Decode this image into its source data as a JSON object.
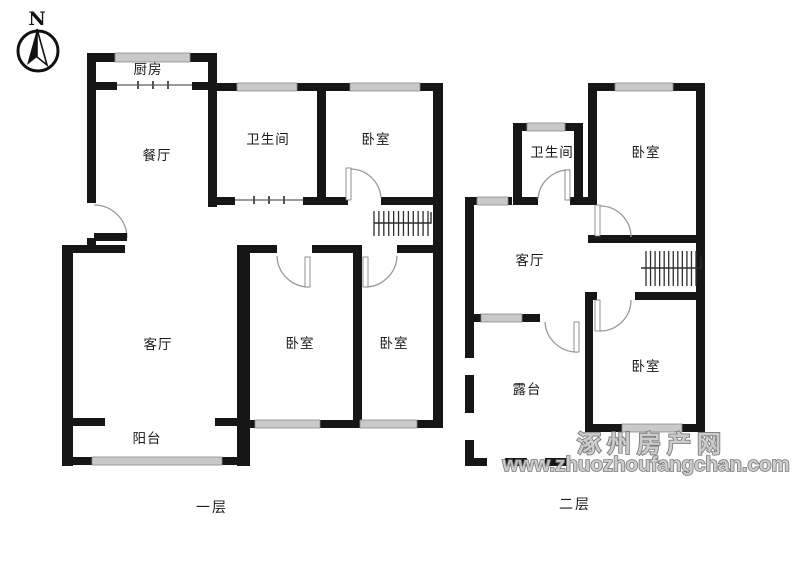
{
  "compass": {
    "label": "N"
  },
  "watermark": {
    "line1": "涿州房产网",
    "line2": "www.zhuozhoufangchan.com",
    "fill_color": "#c9c9c9",
    "outline_color": "#6e6e6e"
  },
  "palette": {
    "wall": "#161616",
    "window": "#c9c9c9",
    "door_arc": "#999999",
    "stairs": "#2e2e2e"
  },
  "floors": [
    {
      "caption": "一层",
      "rooms": [
        {
          "label": "厨房",
          "cx": 148,
          "cy": 69
        },
        {
          "label": "餐厅",
          "cx": 157,
          "cy": 155
        },
        {
          "label": "卫生间",
          "cx": 268,
          "cy": 139
        },
        {
          "label": "卧室",
          "cx": 376,
          "cy": 139
        },
        {
          "label": "客厅",
          "cx": 158,
          "cy": 344
        },
        {
          "label": "卧室",
          "cx": 300,
          "cy": 343
        },
        {
          "label": "卧室",
          "cx": 394,
          "cy": 343
        },
        {
          "label": "阳台",
          "cx": 147,
          "cy": 438
        }
      ],
      "geometry": {
        "walls": [
          [
            87,
            53,
            130,
            9
          ],
          [
            87,
            53,
            9,
            150
          ],
          [
            87,
            238,
            9,
            10
          ],
          [
            87,
            82,
            30,
            8
          ],
          [
            192,
            82,
            25,
            8
          ],
          [
            208,
            53,
            9,
            154
          ],
          [
            217,
            83,
            226,
            8
          ],
          [
            317,
            83,
            9,
            122
          ],
          [
            433,
            83,
            10,
            345
          ],
          [
            208,
            197,
            27,
            8
          ],
          [
            303,
            197,
            45,
            8
          ],
          [
            381,
            197,
            62,
            8
          ],
          [
            62,
            245,
            63,
            8
          ],
          [
            237,
            245,
            40,
            8
          ],
          [
            312,
            245,
            48,
            8
          ],
          [
            397,
            245,
            46,
            8
          ],
          [
            62,
            245,
            11,
            221
          ],
          [
            237,
            245,
            13,
            221
          ],
          [
            353,
            245,
            9,
            183
          ],
          [
            237,
            420,
            206,
            8
          ],
          [
            62,
            418,
            43,
            8
          ],
          [
            215,
            418,
            35,
            8
          ],
          [
            62,
            457,
            186,
            8
          ]
        ],
        "windows": [
          [
            115,
            53,
            75,
            9
          ],
          [
            237,
            83,
            60,
            8
          ],
          [
            350,
            83,
            70,
            8
          ],
          [
            255,
            420,
            65,
            8
          ],
          [
            360,
            420,
            57,
            8
          ],
          [
            92,
            457,
            130,
            8
          ]
        ],
        "thin_lines": [
          {
            "x": 117,
            "y": 84,
            "len": 75,
            "ticks": [
              137,
              152,
              167
            ]
          },
          {
            "x": 235,
            "y": 199,
            "len": 68,
            "ticks": [
              253,
              268,
              283
            ]
          }
        ],
        "dashes": [],
        "doors": [
          {
            "leaf": [
              94,
              233,
              33,
              8
            ],
            "style": "solid",
            "arc": "M 94 205 A 33 33 0 0 1 127 238"
          },
          {
            "leaf": [
              346,
              168,
              5,
              32
            ],
            "style": "open",
            "arc": "M 351 169 A 31 31 0 0 1 381 198"
          },
          {
            "leaf": [
              305,
              257,
              5,
              30
            ],
            "style": "open",
            "arc": "M 277 256 A 32 32 0 0 0 309 287"
          },
          {
            "leaf": [
              363,
              257,
              5,
              30
            ],
            "style": "open",
            "arc": "M 366 287 A 32 32 0 0 0 397 256"
          }
        ],
        "stairs": {
          "x": 374,
          "y": 211,
          "w": 54,
          "h": 25,
          "steps": 12,
          "line": "M 374 223 L 431 223 L 431 212"
        }
      }
    },
    {
      "caption": "二层",
      "rooms": [
        {
          "label": "卫生间",
          "cx": 552,
          "cy": 152
        },
        {
          "label": "卧室",
          "cx": 646,
          "cy": 152
        },
        {
          "label": "客厅",
          "cx": 530,
          "cy": 260
        },
        {
          "label": "卧室",
          "cx": 646,
          "cy": 366
        },
        {
          "label": "露台",
          "cx": 527,
          "cy": 389
        }
      ],
      "geometry": {
        "walls": [
          [
            465,
            197,
            9,
            161
          ],
          [
            465,
            197,
            47,
            8
          ],
          [
            513,
            123,
            9,
            82
          ],
          [
            513,
            123,
            70,
            8
          ],
          [
            574,
            123,
            9,
            82
          ],
          [
            513,
            197,
            25,
            8
          ],
          [
            570,
            197,
            27,
            8
          ],
          [
            588,
            83,
            9,
            122
          ],
          [
            588,
            83,
            117,
            8
          ],
          [
            696,
            83,
            9,
            349
          ],
          [
            588,
            235,
            117,
            8
          ],
          [
            588,
            292,
            9,
            8
          ],
          [
            635,
            292,
            70,
            8
          ],
          [
            585,
            292,
            8,
            140
          ],
          [
            585,
            424,
            120,
            8
          ],
          [
            465,
            314,
            16,
            8
          ],
          [
            522,
            314,
            18,
            8
          ]
        ],
        "windows": [
          [
            477,
            197,
            31,
            8
          ],
          [
            527,
            123,
            38,
            8
          ],
          [
            615,
            83,
            58,
            8
          ],
          [
            622,
            424,
            60,
            8
          ],
          [
            481,
            314,
            41,
            8
          ]
        ],
        "thin_lines": [],
        "dashes": [
          [
            465,
            375,
            9,
            38
          ],
          [
            465,
            440,
            9,
            26
          ],
          [
            465,
            458,
            22,
            8
          ],
          [
            505,
            458,
            22,
            8
          ],
          [
            545,
            458,
            22,
            8
          ]
        ],
        "doors": [
          {
            "leaf": [
              565,
              170,
              5,
              30
            ],
            "style": "open",
            "arc": "M 538 199 A 31 31 0 0 1 570 170"
          },
          {
            "leaf": [
              595,
              205,
              5,
              31
            ],
            "style": "open",
            "arc": "M 600 206 A 31 31 0 0 1 631 237"
          },
          {
            "leaf": [
              595,
              300,
              5,
              31
            ],
            "style": "open",
            "arc": "M 600 331 A 31 31 0 0 0 631 300"
          },
          {
            "leaf": [
              574,
              322,
              5,
              30
            ],
            "style": "open",
            "arc": "M 545 322 A 32 32 0 0 0 578 352"
          }
        ],
        "stairs": {
          "x": 646,
          "y": 251,
          "w": 50,
          "h": 35,
          "steps": 12,
          "line": "M 641 268 L 701 268 L 701 257"
        }
      }
    }
  ]
}
